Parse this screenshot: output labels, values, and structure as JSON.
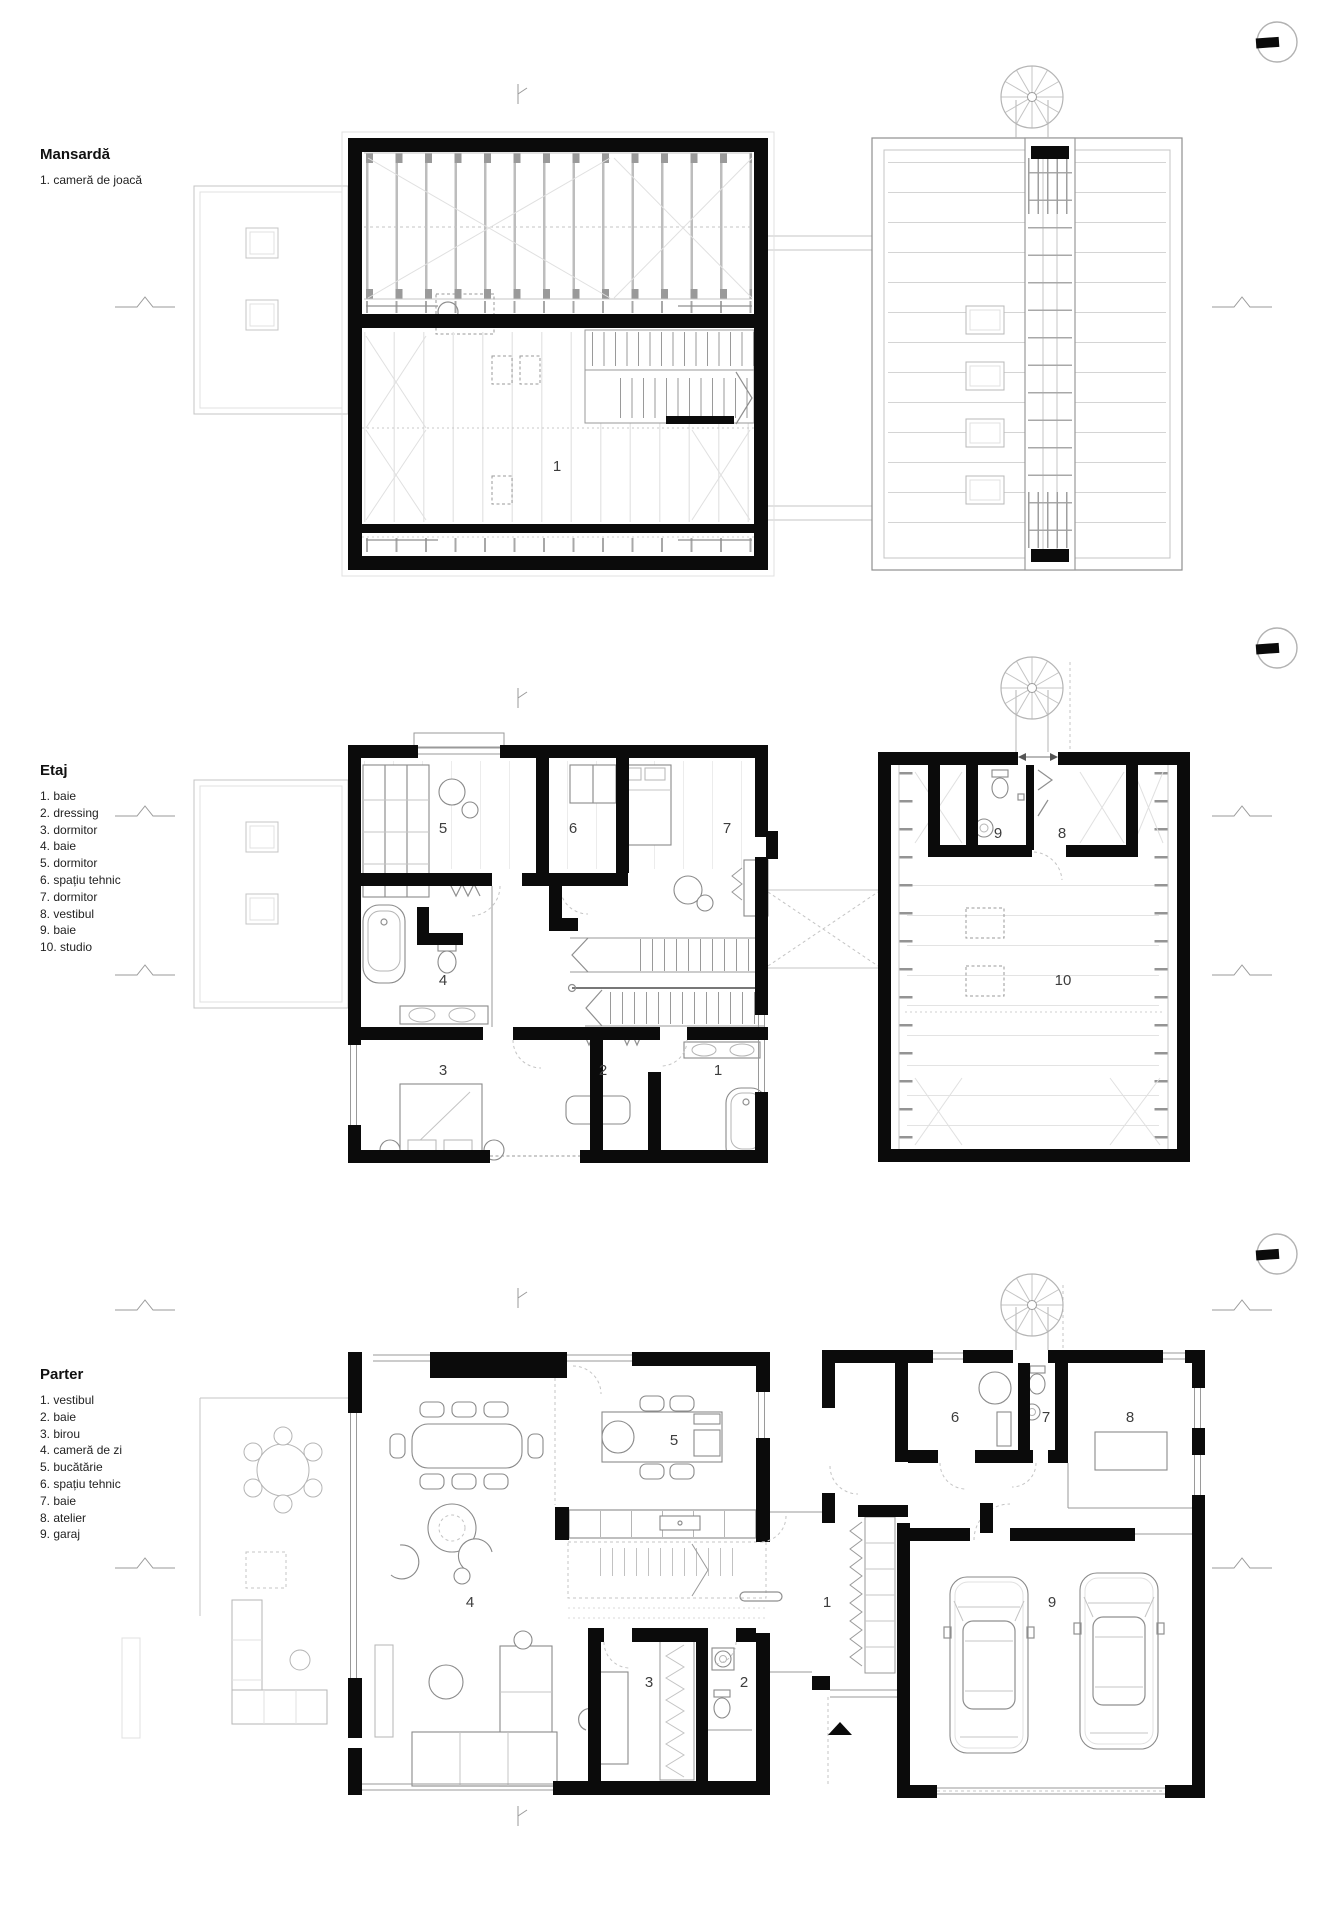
{
  "document": {
    "type": "floor-plan-sheet",
    "background": "#ffffff"
  },
  "sections": [
    {
      "id": "mansarda",
      "title": "Mansardă",
      "legend": [
        "1. cameră de joacă"
      ]
    },
    {
      "id": "etaj",
      "title": "Etaj",
      "legend": [
        "1. baie",
        "2. dressing",
        "3. dormitor",
        "4. baie",
        "5. dormitor",
        "6. spațiu tehnic",
        "7. dormitor",
        "8. vestibul",
        "9. baie",
        "10. studio"
      ]
    },
    {
      "id": "parter",
      "title": "Parter",
      "legend": [
        "1. vestibul",
        "2. baie",
        "3. birou",
        "4. cameră de zi",
        "5. bucătărie",
        "6. spațiu tehnic",
        "7. baie",
        "8. atelier",
        "9. garaj"
      ]
    }
  ],
  "labels": {
    "mansarda": {
      "r1": "1"
    },
    "etaj": {
      "r1": "1",
      "r2": "2",
      "r3": "3",
      "r4": "4",
      "r5": "5",
      "r6": "6",
      "r7": "7",
      "r8": "8",
      "r9": "9",
      "r10": "10"
    },
    "parter": {
      "r1": "1",
      "r2": "2",
      "r3": "3",
      "r4": "4",
      "r5": "5",
      "r6": "6",
      "r7": "7",
      "r8": "8",
      "r9": "9"
    }
  },
  "icons": {
    "north_marker": "circle-with-solid-needle",
    "spiral_stair": "spiral-staircase",
    "entrance_arrow": "solid-triangle"
  },
  "colors": {
    "wall": "#0b0b0b",
    "line_strong": "#8f8f8f",
    "line_light": "#c4c4c4",
    "line_faint": "#e2e2e2",
    "text": "#1a1a1a",
    "room_number": "#3d3d3d"
  }
}
